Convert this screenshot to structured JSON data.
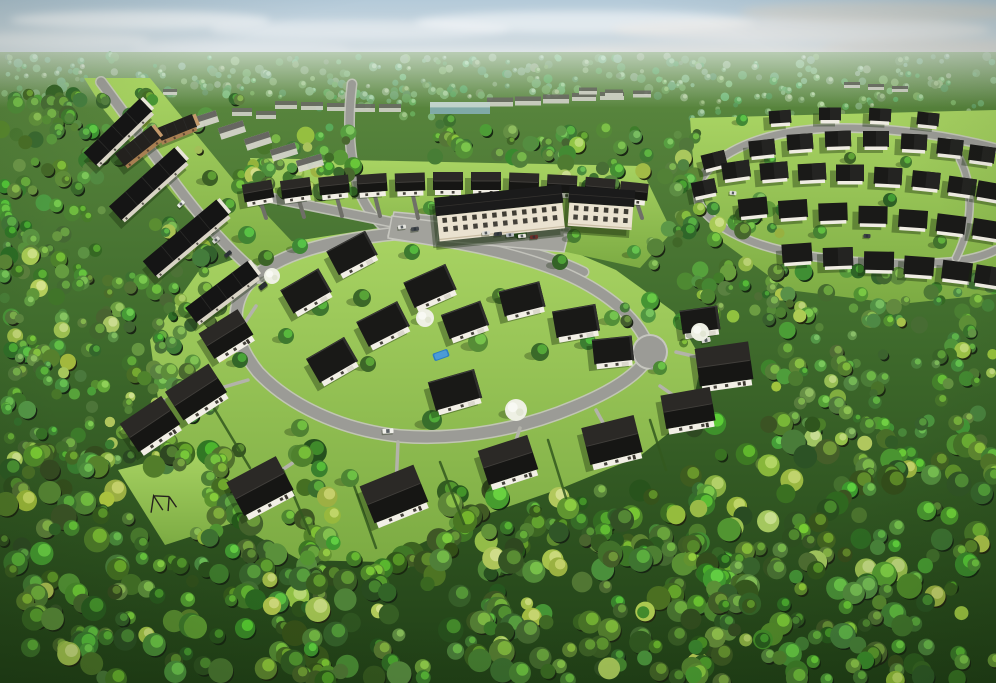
{
  "meta": {
    "title": "Aerial 3D rendering of a residential development surrounded by dense forest",
    "view": "high-angle aerial",
    "time_of_day": "daytime, sunny with light haze",
    "width": 996,
    "height": 683
  },
  "palette": {
    "sky_top": "#b4cad9",
    "sky_mid": "#cdd9e0",
    "sky_horizon": "#e9ecea",
    "forest_top": "#5d8a40",
    "forest_mid": "#3f6b2c",
    "forest_dark": "#203f16",
    "lawn_light": "#a9d463",
    "lawn_dark": "#7cab43",
    "road_asphalt": "#9b9b96",
    "road_curb": "#c6c6bf",
    "driveway_dark": "#6f6f68",
    "driveway_light": "#b3b3aa",
    "roof_dark": "#191917",
    "roof_slope_light": "#2b2926",
    "roof_ridge": "#403e3a",
    "wall_white": "#f2efe6",
    "wall_shade": "#d9d4c6",
    "wall_tan": "#a87f52",
    "wall_tan_dark": "#5c4733",
    "condo_facade": "#eae2d0",
    "window_dark": "#44413a",
    "pool_blue": "#2d7dc2",
    "pool_blue_light": "#4f9fd9",
    "tree_white": "#eef0e4",
    "hedge_green": "#33591f",
    "shadow": "rgba(24,44,12,0.38)",
    "distant_body": "#d4d3cc",
    "distant_roof": "#6a6a64",
    "teal_body": "#86b0b6",
    "teal_top": "#cfdede"
  },
  "sky": {
    "clouds": [
      [
        140,
        20,
        130,
        9,
        "#ffffff",
        0.55
      ],
      [
        360,
        30,
        150,
        10,
        "#f4f6f7",
        0.5
      ],
      [
        585,
        22,
        170,
        11,
        "#ffffff",
        0.5
      ],
      [
        800,
        30,
        190,
        12,
        "#eceae6",
        0.6
      ],
      [
        930,
        48,
        110,
        9,
        "#ded8cf",
        0.5
      ],
      [
        700,
        52,
        150,
        8,
        "#e6e2db",
        0.45
      ],
      [
        240,
        48,
        110,
        7,
        "#eef1f2",
        0.4
      ],
      [
        480,
        55,
        160,
        7,
        "#edeff0",
        0.4
      ],
      [
        60,
        40,
        90,
        8,
        "#f2f4f5",
        0.45
      ],
      [
        880,
        12,
        140,
        10,
        "#d9d3c9",
        0.55
      ]
    ]
  },
  "distant": {
    "blocks": [
      [
        286,
        105,
        22,
        8
      ],
      [
        312,
        106,
        22,
        8
      ],
      [
        338,
        107,
        22,
        8
      ],
      [
        364,
        108,
        22,
        8
      ],
      [
        390,
        108,
        22,
        8
      ],
      [
        242,
        112,
        20,
        8
      ],
      [
        266,
        115,
        20,
        8
      ],
      [
        500,
        102,
        26,
        9
      ],
      [
        528,
        101,
        26,
        9
      ],
      [
        556,
        99,
        26,
        9
      ],
      [
        584,
        97,
        24,
        8
      ],
      [
        612,
        96,
        24,
        8
      ],
      [
        588,
        91,
        18,
        7
      ],
      [
        614,
        93,
        18,
        7
      ],
      [
        642,
        94,
        18,
        7
      ],
      [
        852,
        85,
        16,
        6
      ],
      [
        876,
        87,
        16,
        6
      ],
      [
        900,
        89,
        16,
        6
      ],
      [
        148,
        88,
        14,
        6
      ],
      [
        170,
        92,
        14,
        6
      ]
    ],
    "teal_building": [
      460,
      108,
      60,
      12
    ]
  },
  "forest": {
    "zones_far": [
      [
        0,
        56,
        996,
        42,
        320
      ],
      [
        688,
        98,
        308,
        26,
        40
      ],
      [
        318,
        90,
        130,
        38,
        20
      ]
    ],
    "zones_main": [
      [
        90,
        92,
        150,
        70,
        22,
        "mid"
      ],
      [
        0,
        92,
        108,
        190,
        90,
        "mid"
      ],
      [
        232,
        132,
        128,
        62,
        30,
        "mid"
      ],
      [
        430,
        118,
        150,
        42,
        26,
        "mid"
      ],
      [
        560,
        130,
        140,
        66,
        38,
        "mid"
      ],
      [
        250,
        152,
        120,
        44,
        18,
        "mid"
      ],
      [
        150,
        212,
        62,
        88,
        20,
        "mid"
      ],
      [
        648,
        192,
        135,
        125,
        55,
        "mid"
      ],
      [
        0,
        268,
        175,
        200,
        120,
        "mid"
      ],
      [
        768,
        268,
        228,
        175,
        120,
        "mid"
      ],
      [
        152,
        296,
        70,
        120,
        25,
        "mid"
      ],
      [
        618,
        300,
        72,
        56,
        10,
        "mid"
      ],
      [
        0,
        448,
        330,
        235,
        200,
        "fg"
      ],
      [
        300,
        515,
        430,
        168,
        160,
        "fg"
      ],
      [
        440,
        490,
        260,
        80,
        60,
        "fg"
      ],
      [
        690,
        420,
        306,
        263,
        200,
        "fg"
      ]
    ],
    "clearings": [
      [
        170,
        505,
        36
      ],
      [
        265,
        480,
        38
      ],
      [
        395,
        516,
        40
      ],
      [
        648,
        352,
        22
      ]
    ]
  },
  "lawns": {
    "central": "M 150,340 L 198,272 L 276,244 L 392,226 L 470,228 L 560,246 L 616,270 L 674,312 L 702,360 L 690,416 L 640,456 L 562,488 L 470,520 L 382,562 L 300,560 L 214,512 L 164,444 Z",
    "upper_left": "M 84,78 L 150,78 L 232,178 L 302,252 L 258,284 L 176,198 L 104,110 Z",
    "top_strip": "M 250,158 L 640,166 L 672,232 L 640,268 L 520,242 L 330,214 L 258,192 Z",
    "upper_right": "M 690,118 L 996,110 L 996,294 L 900,304 L 788,290 L 720,240 L 694,174 Z",
    "swing_clearing": "M 118,470 L 205,448 L 242,520 L 165,545 Z"
  },
  "roads": {
    "streets": [
      {
        "d": "M 101,82 C 122,110 149,148 177,186 C 201,218 224,244 246,264 C 252,269 256,273 260,278",
        "w": 9
      },
      {
        "d": "M 352,84 C 348,116 348,152 358,186 C 362,202 372,218 392,234",
        "w": 8
      },
      {
        "d": "M 262,196 C 330,210 400,224 470,238 C 520,248 556,258 584,272",
        "w": 8
      },
      {
        "d": "M 392,234 C 450,240 510,252 556,270 C 596,286 625,308 640,330 C 646,340 650,346 650,352",
        "w": 10
      },
      {
        "d": "M 392,234 C 336,240 276,252 248,284 C 230,306 232,340 258,372 C 288,404 340,430 400,436 C 462,441 524,428 574,407 C 618,389 644,370 650,352",
        "w": 11
      },
      {
        "d": "M 996,148 C 950,136 896,128 842,128 C 788,128 744,140 716,162 C 700,175 694,190 700,206 C 714,226 744,242 784,251 C 838,263 900,266 950,262 C 968,260 984,256 996,250",
        "w": 7
      },
      {
        "d": "M 948,142 C 972,168 978,214 956,258",
        "w": 6
      }
    ],
    "culdesac": [
      650,
      352,
      16
    ],
    "parking_lots": [
      "M 394,212 L 570,228 L 564,252 L 388,236 Z",
      "M 392,216 L 440,222 L 436,246 L 388,238 Z"
    ],
    "driveways_dark": [
      [
        260,
        200,
        266,
        218
      ],
      [
        298,
        197,
        304,
        217
      ],
      [
        336,
        194,
        342,
        216
      ],
      [
        374,
        192,
        380,
        216
      ],
      [
        412,
        191,
        418,
        218
      ],
      [
        450,
        190,
        456,
        214
      ],
      [
        600,
        196,
        606,
        216
      ],
      [
        636,
        200,
        642,
        218
      ]
    ],
    "driveways_light": [
      [
        214,
        390,
        248,
        380
      ],
      [
        270,
        478,
        318,
        446
      ],
      [
        396,
        488,
        398,
        442
      ],
      [
        512,
        452,
        520,
        428
      ],
      [
        607,
        430,
        596,
        410
      ],
      [
        680,
        400,
        660,
        386
      ],
      [
        710,
        360,
        676,
        352
      ],
      [
        240,
        330,
        256,
        306
      ],
      [
        150,
        418,
        164,
        400
      ]
    ]
  },
  "hedges": [
    [
      283,
      470,
      310,
      534
    ],
    [
      352,
      480,
      376,
      548
    ],
    [
      440,
      462,
      464,
      524
    ],
    [
      548,
      440,
      566,
      498
    ],
    [
      214,
      408,
      250,
      468
    ],
    [
      650,
      420,
      666,
      470
    ]
  ],
  "houses": [
    [
      "rowdark",
      118,
      132,
      78,
      18,
      -44
    ],
    [
      "rowdark",
      148,
      184,
      88,
      19,
      -42
    ],
    [
      "rowdark",
      186,
      238,
      96,
      20,
      -40
    ],
    [
      "rowdark",
      222,
      292,
      78,
      19,
      -37
    ],
    [
      "tanrow",
      138,
      146,
      46,
      16,
      -38
    ],
    [
      "tanrow",
      176,
      128,
      40,
      14,
      -22
    ],
    [
      "hazy",
      205,
      120,
      26,
      12,
      -18
    ],
    [
      "hazy",
      232,
      130,
      26,
      12,
      -18
    ],
    [
      "hazy",
      258,
      141,
      26,
      12,
      -18
    ],
    [
      "hazy",
      284,
      152,
      26,
      12,
      -17
    ],
    [
      "hazy",
      310,
      163,
      26,
      12,
      -16
    ],
    [
      "toprow",
      258,
      191,
      30,
      18,
      -10
    ],
    [
      "toprow",
      296,
      188,
      30,
      18,
      -8
    ],
    [
      "toprow",
      334,
      185,
      30,
      18,
      -6
    ],
    [
      "toprow",
      372,
      183,
      30,
      18,
      -4
    ],
    [
      "toprow",
      410,
      182,
      30,
      18,
      -2
    ],
    [
      "toprow",
      448,
      181,
      30,
      18,
      0
    ],
    [
      "toprow",
      486,
      181,
      30,
      18,
      0
    ],
    [
      "toprow",
      524,
      182,
      30,
      18,
      2
    ],
    [
      "toprow",
      562,
      184,
      30,
      18,
      3
    ],
    [
      "toprow",
      600,
      187,
      30,
      18,
      5
    ],
    [
      "toprow",
      634,
      191,
      28,
      17,
      6
    ],
    [
      "condo",
      500,
      213,
      128,
      44,
      -6
    ],
    [
      "condo",
      601,
      208,
      66,
      40,
      4
    ],
    [
      "flat",
      352,
      253,
      44,
      27,
      -28
    ],
    [
      "flat",
      306,
      291,
      44,
      27,
      -30
    ],
    [
      "flat",
      430,
      286,
      46,
      28,
      -24
    ],
    [
      "flat",
      383,
      324,
      46,
      28,
      -27
    ],
    [
      "flat",
      465,
      320,
      42,
      26,
      -20
    ],
    [
      "flat",
      522,
      299,
      42,
      26,
      -14
    ],
    [
      "flat",
      576,
      321,
      44,
      27,
      -10
    ],
    [
      "flat",
      613,
      350,
      40,
      25,
      -6
    ],
    [
      "flat",
      332,
      360,
      44,
      28,
      -30
    ],
    [
      "flat",
      455,
      390,
      48,
      30,
      -16
    ],
    [
      "flat",
      700,
      320,
      38,
      24,
      -8
    ],
    [
      "pitch",
      226,
      334,
      46,
      30,
      -32
    ],
    [
      "pitch",
      196,
      392,
      52,
      34,
      -33
    ],
    [
      "pitch",
      150,
      424,
      50,
      34,
      -34
    ],
    [
      "pitch",
      260,
      486,
      56,
      38,
      -28
    ],
    [
      "pitch",
      394,
      494,
      58,
      40,
      -22
    ],
    [
      "pitch",
      508,
      460,
      52,
      36,
      -18
    ],
    [
      "pitch",
      612,
      440,
      54,
      38,
      -14
    ],
    [
      "pitch",
      688,
      408,
      50,
      34,
      -10
    ],
    [
      "pitch",
      724,
      364,
      54,
      38,
      -8
    ],
    [
      "small",
      780,
      117,
      22,
      13,
      -4
    ],
    [
      "small",
      830,
      114,
      22,
      13,
      0
    ],
    [
      "small",
      880,
      115,
      22,
      13,
      3
    ],
    [
      "small",
      928,
      119,
      22,
      13,
      6
    ],
    [
      "small",
      762,
      148,
      26,
      16,
      -6
    ],
    [
      "small",
      800,
      142,
      26,
      16,
      -4
    ],
    [
      "small",
      838,
      139,
      26,
      16,
      -2
    ],
    [
      "small",
      876,
      139,
      26,
      16,
      0
    ],
    [
      "small",
      914,
      142,
      26,
      16,
      3
    ],
    [
      "small",
      950,
      147,
      26,
      16,
      6
    ],
    [
      "small",
      982,
      154,
      26,
      16,
      8
    ],
    [
      "small",
      736,
      170,
      28,
      17,
      -8
    ],
    [
      "small",
      774,
      171,
      28,
      17,
      -5
    ],
    [
      "small",
      812,
      172,
      28,
      17,
      -3
    ],
    [
      "small",
      850,
      173,
      28,
      17,
      0
    ],
    [
      "small",
      888,
      176,
      28,
      17,
      3
    ],
    [
      "small",
      926,
      180,
      28,
      17,
      6
    ],
    [
      "small",
      962,
      186,
      28,
      17,
      8
    ],
    [
      "small",
      991,
      191,
      28,
      17,
      10
    ],
    [
      "small",
      753,
      207,
      29,
      18,
      -6
    ],
    [
      "small",
      793,
      209,
      29,
      18,
      -4
    ],
    [
      "small",
      833,
      212,
      29,
      18,
      -2
    ],
    [
      "small",
      873,
      215,
      29,
      18,
      1
    ],
    [
      "small",
      913,
      219,
      29,
      18,
      4
    ],
    [
      "small",
      951,
      224,
      29,
      18,
      7
    ],
    [
      "small",
      987,
      229,
      29,
      18,
      9
    ],
    [
      "small",
      797,
      253,
      30,
      19,
      -4
    ],
    [
      "small",
      838,
      257,
      30,
      19,
      -2
    ],
    [
      "small",
      879,
      261,
      30,
      19,
      1
    ],
    [
      "small",
      919,
      266,
      30,
      19,
      4
    ],
    [
      "small",
      957,
      271,
      30,
      19,
      7
    ],
    [
      "small",
      990,
      276,
      30,
      19,
      9
    ],
    [
      "small",
      714,
      160,
      24,
      15,
      -14
    ],
    [
      "small",
      704,
      188,
      24,
      15,
      -12
    ]
  ],
  "cars": [
    [
      388,
      431,
      11,
      5,
      -4,
      "#f0f0ea"
    ],
    [
      263,
      286,
      9,
      5,
      -38,
      "#2a2d30"
    ],
    [
      181,
      204,
      8,
      4,
      -44,
      "#eceee9"
    ],
    [
      216,
      240,
      8,
      4,
      -42,
      "#d6d6d0"
    ],
    [
      228,
      254,
      8,
      4,
      -40,
      "#2e3236"
    ],
    [
      486,
      233,
      8,
      4,
      -6,
      "#dcdcd6"
    ],
    [
      498,
      234,
      8,
      4,
      -6,
      "#3a3e42"
    ],
    [
      510,
      235,
      8,
      4,
      -6,
      "#b9bdc1"
    ],
    [
      522,
      236,
      8,
      4,
      -6,
      "#e8e6df"
    ],
    [
      534,
      237,
      8,
      4,
      -6,
      "#6b2f2a"
    ],
    [
      402,
      227,
      8,
      4,
      -8,
      "#e5e5df"
    ],
    [
      415,
      229,
      8,
      4,
      -8,
      "#454a4e"
    ],
    [
      733,
      193,
      7,
      4,
      5,
      "#e2e2dc"
    ],
    [
      867,
      236,
      7,
      4,
      3,
      "#3c4044"
    ],
    [
      706,
      340,
      9,
      5,
      -12,
      "#dadad4"
    ]
  ],
  "pool": [
    441,
    355,
    -20
  ],
  "swing_set": [
    158,
    502,
    -12
  ],
  "accent_trees": {
    "green": [
      [
        210,
        178,
        8
      ],
      [
        228,
        206,
        8
      ],
      [
        247,
        235,
        9
      ],
      [
        266,
        258,
        8
      ],
      [
        320,
        307,
        9
      ],
      [
        300,
        246,
        8
      ],
      [
        362,
        298,
        9
      ],
      [
        412,
        252,
        8
      ],
      [
        478,
        342,
        10
      ],
      [
        540,
        352,
        9
      ],
      [
        588,
        342,
        8
      ],
      [
        612,
        318,
        8
      ],
      [
        432,
        420,
        10
      ],
      [
        300,
        428,
        9
      ],
      [
        520,
        448,
        10
      ],
      [
        610,
        430,
        8
      ],
      [
        350,
        478,
        9
      ],
      [
        560,
        262,
        8
      ],
      [
        500,
        296,
        8
      ],
      [
        660,
        368,
        7
      ],
      [
        240,
        360,
        8
      ],
      [
        186,
        310,
        8
      ],
      [
        430,
        208,
        7
      ],
      [
        520,
        232,
        7
      ],
      [
        574,
        236,
        7
      ],
      [
        634,
        252,
        7
      ],
      [
        742,
        214,
        7
      ],
      [
        820,
        232,
        7
      ],
      [
        890,
        200,
        7
      ],
      [
        940,
        242,
        7
      ],
      [
        770,
        160,
        6
      ],
      [
        850,
        158,
        6
      ],
      [
        906,
        162,
        6
      ],
      [
        742,
        120,
        6
      ],
      [
        368,
        364,
        8
      ],
      [
        286,
        336,
        8
      ]
    ],
    "white": [
      [
        425,
        318,
        9
      ],
      [
        516,
        410,
        11
      ],
      [
        700,
        332,
        9
      ],
      [
        272,
        276,
        8
      ]
    ]
  }
}
